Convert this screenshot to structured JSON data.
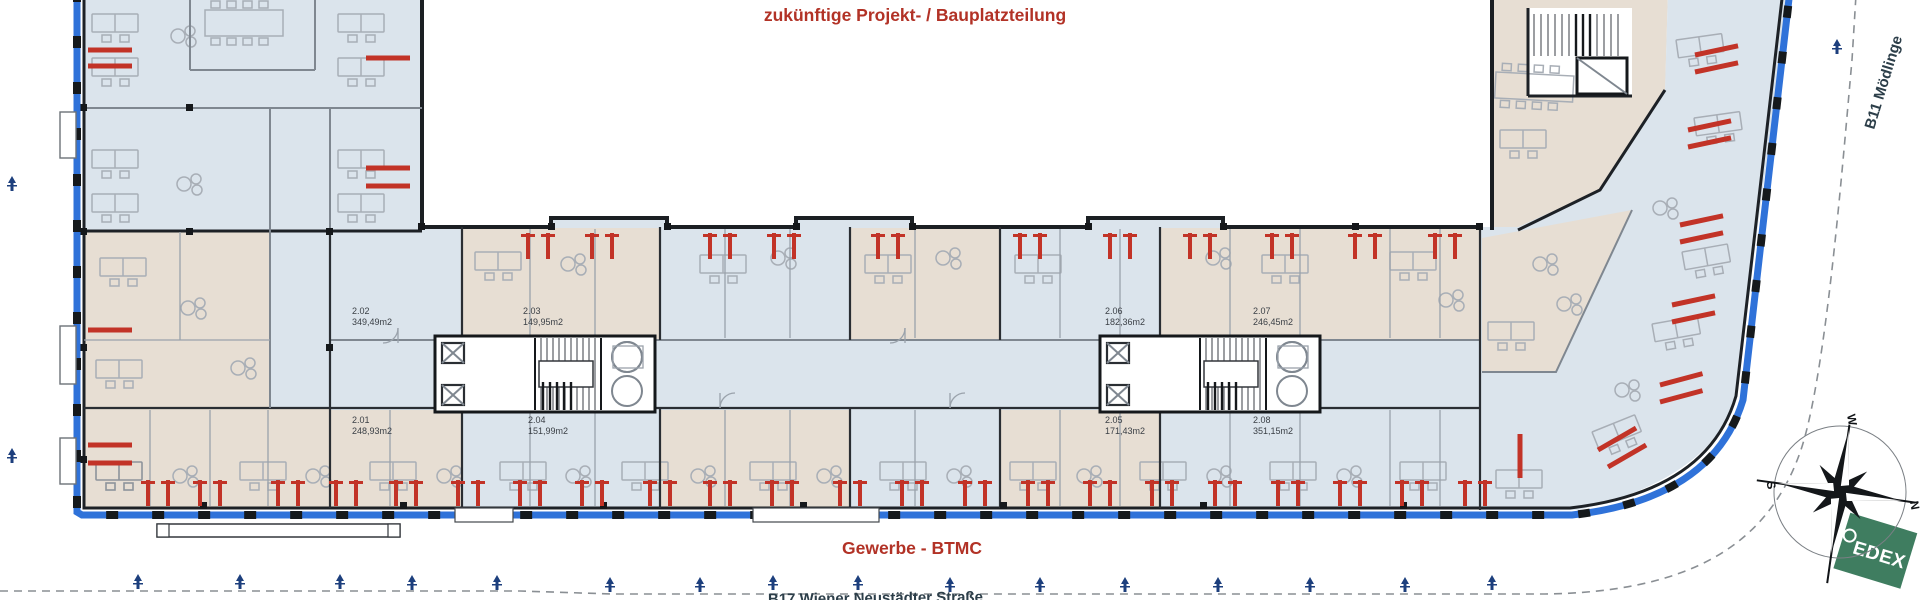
{
  "plan": {
    "future_label": "zukünftige Projekt- / Bauplatzteilung",
    "commercial_label": "Gewerbe - BTMC",
    "road_right_label": "B11 Mödlinge",
    "road_bottom_label": "B17 Wiener Neustädter Straße"
  },
  "rooms": [
    {
      "id": "2.01",
      "area": "248,93m2"
    },
    {
      "id": "2.02",
      "area": "349,49m2"
    },
    {
      "id": "2.03",
      "area": "149,95m2"
    },
    {
      "id": "2.04",
      "area": "151,99m2"
    },
    {
      "id": "2.05",
      "area": "171,43m2"
    },
    {
      "id": "2.06",
      "area": "182,36m2"
    },
    {
      "id": "2.07",
      "area": "246,45m2"
    },
    {
      "id": "2.08",
      "area": "351,15m2"
    }
  ],
  "compass": {
    "n": "N",
    "s": "S",
    "w": "W"
  },
  "logo": {
    "text": "EDEX"
  },
  "colors": {
    "annotation_red": "#b23226",
    "road_label": "#2c3e49",
    "boundary_blue": "#2f72d9",
    "marker_blue": "#1d3f7d",
    "radiator_red": "#c23327",
    "room_fill_blue": "#dbe4ec",
    "room_fill_beige": "#e7ded3",
    "logo_green": "#3f7d60",
    "wall_dark": "#1d2126"
  }
}
